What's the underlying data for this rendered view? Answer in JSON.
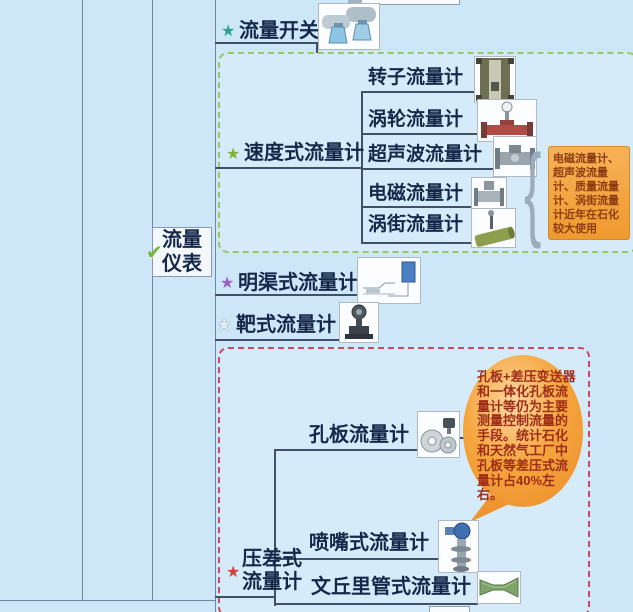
{
  "canvas": {
    "width": 633,
    "height": 612
  },
  "colors": {
    "background": "#cde7f8",
    "grid_line": "#7089a2",
    "connector": "#3f5068",
    "node_text": "#16284a",
    "green_group_border": "#97c767",
    "pink_group_border": "#c84a64",
    "note_bg": "#f3a443",
    "note_text": "#8e3c12",
    "bubble_fill": "#f5a53d",
    "bubble_text": "#9e2d18"
  },
  "icons": {
    "star": "★",
    "check": "✔"
  },
  "root": {
    "label": "流量仪表",
    "lines": [
      "流量",
      "仪表"
    ]
  },
  "branches": [
    {
      "label": "流量开关",
      "star_color": "#2e9e96"
    },
    {
      "label": "速度式流量计",
      "star_color": "#7fb43a",
      "children": [
        "转子流量计",
        "涡轮流量计",
        "超声波流量计",
        "电磁流量计",
        "涡街流量计"
      ],
      "note": "电磁流量计、超声波流量计、质量流量计、涡街流量计近年在石化较大使用"
    },
    {
      "label": "明渠式流量计",
      "star_color": "#9a5fc0"
    },
    {
      "label": "靶式流量计",
      "star_color": "#e6ecf1"
    },
    {
      "label": "压差式流量计",
      "lines": [
        "压差式",
        "流量计"
      ],
      "star_color": "#d8403c",
      "children": [
        "孔板流量计",
        "喷嘴式流量计",
        "文丘里管式流量计"
      ],
      "note": "孔板+差压变送器和一体化孔板流量计等仍为主要测量控制流量的手段。统计石化和天然气工厂中孔板等差压式流量计占40%左右。"
    }
  ]
}
